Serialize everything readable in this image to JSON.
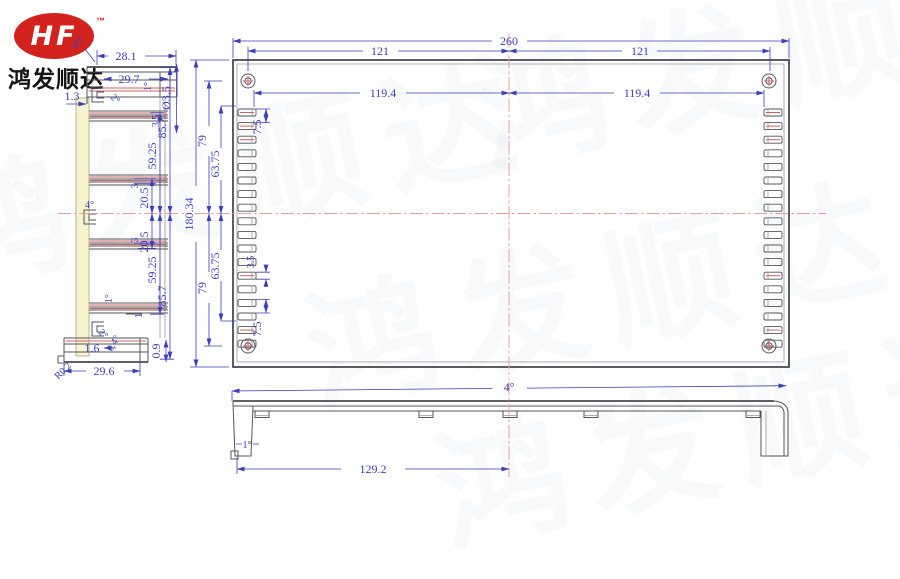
{
  "logo": {
    "brand": "HF",
    "trademark": "™",
    "company": "鸿发顺达"
  },
  "watermark": {
    "text": "鸿发顺达"
  },
  "colors": {
    "dimension": "#3d3dbe",
    "drawing": "#54545a",
    "centerline": "#eb9c9c",
    "highlight_red": "#d06060",
    "wall_fill": "#f7f3cc",
    "logo_red": "#d2231e"
  },
  "side_view": {
    "d28_1": "28.1",
    "a45": "45°",
    "d29_7": "29.7",
    "d1_3": "1.3",
    "a2_top": "2°",
    "a1_top": "1°",
    "dia3_5": "Ø3.5",
    "d3_5": "3.5",
    "d85_7_top": "85.7",
    "d59_25_top": "59.25",
    "d3_top": "3",
    "d20_5_top": "20.5",
    "a4_mid": "4°",
    "d3_bot": "3",
    "d20_5_bot": "20.5",
    "d59_25_bot": "59.25",
    "d85_7_bot": "85.7",
    "a1_bot": "1°",
    "d1": "1",
    "a2_bot": "2°",
    "d1_6": "1.6",
    "a0_4": "0.4°",
    "d0_9": "0.9",
    "d29_6": "29.6",
    "r0_2": "R0.2"
  },
  "plan_view": {
    "d260": "260",
    "d121_left": "121",
    "d121_right": "121",
    "d119_4_left": "119.4",
    "d119_4_right": "119.4",
    "d180_34": "180.34",
    "d79_top": "79",
    "d63_75_top": "63.75",
    "d7_5_top": "7.5",
    "d3_5_slot": "3.5",
    "d7_5_bot": "7.5",
    "d63_75_bot": "63.75",
    "d79_bot": "79"
  },
  "front_view": {
    "a4": "4°",
    "a1": "1°",
    "d129_2": "129.2"
  }
}
